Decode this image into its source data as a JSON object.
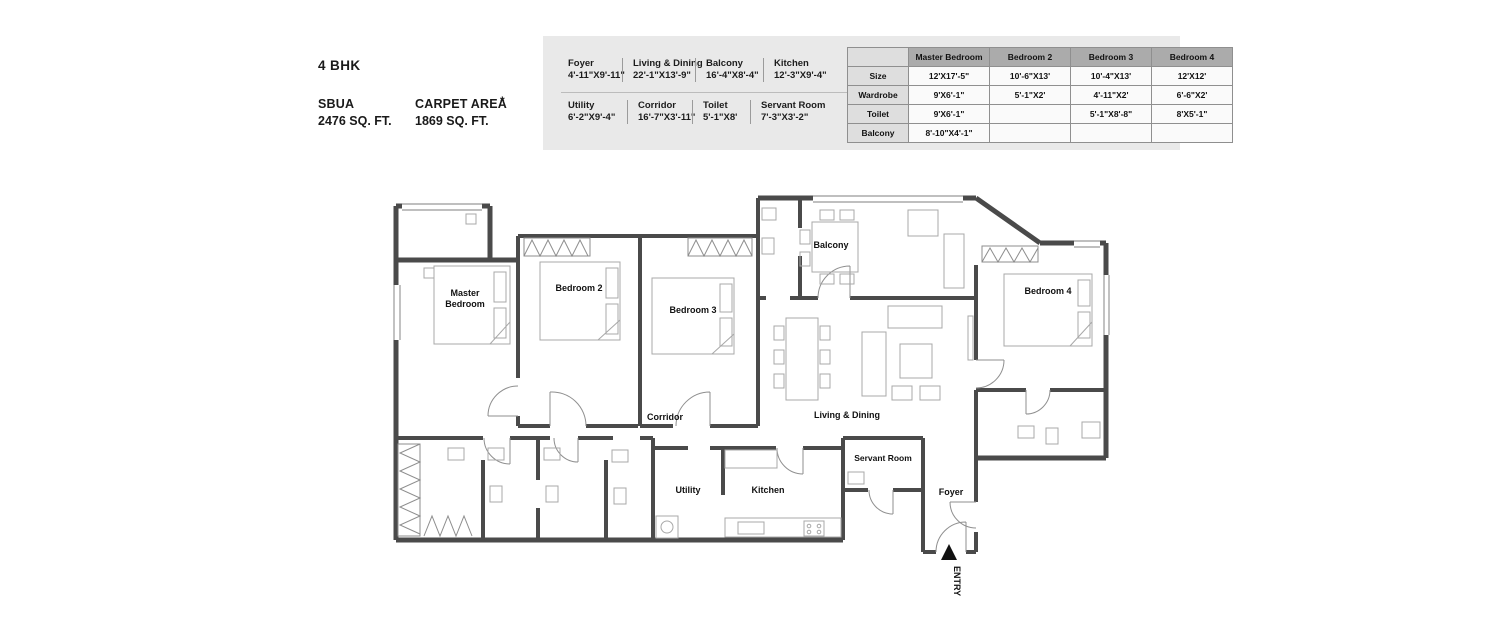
{
  "header": {
    "title": "4 BHK",
    "sbua_label": "SBUA",
    "sbua_value": "2476 SQ. FT.",
    "carpet_label": "CARPET AREA",
    "carpet_note": "*",
    "carpet_value": "1869 SQ. FT."
  },
  "dimensions_panel": {
    "row1": [
      {
        "name": "Foyer",
        "size": "4'-11\"X9'-11\""
      },
      {
        "name": "Living & Dining",
        "size": "22'-1\"X13'-9\""
      },
      {
        "name": "Balcony",
        "size": "16'-4\"X8'-4\""
      },
      {
        "name": "Kitchen",
        "size": "12'-3\"X9'-4\""
      }
    ],
    "row2": [
      {
        "name": "Utility",
        "size": "6'-2\"X9'-4\""
      },
      {
        "name": "Corridor",
        "size": "16'-7\"X3'-11\""
      },
      {
        "name": "Toilet",
        "size": "5'-1\"X8'"
      },
      {
        "name": "Servant Room",
        "size": "7'-3\"X3'-2\""
      }
    ]
  },
  "bedroom_table": {
    "columns": [
      "",
      "Master Bedroom",
      "Bedroom 2",
      "Bedroom 3",
      "Bedroom 4"
    ],
    "rows": [
      {
        "label": "Size",
        "values": [
          "12'X17'-5\"",
          "10'-6\"X13'",
          "10'-4\"X13'",
          "12'X12'"
        ]
      },
      {
        "label": "Wardrobe",
        "values": [
          "9'X6'-1\"",
          "5'-1\"X2'",
          "4'-11\"X2'",
          "6'-6\"X2'"
        ]
      },
      {
        "label": "Toilet",
        "values": [
          "9'X6'-1\"",
          "",
          "5'-1\"X8'-8\"",
          "8'X5'-1\""
        ]
      },
      {
        "label": "Balcony",
        "values": [
          "8'-10\"X4'-1\"",
          "",
          "",
          ""
        ]
      }
    ]
  },
  "floor_plan": {
    "labels": {
      "master_line1": "Master",
      "master_line2": "Bedroom",
      "bedroom2": "Bedroom 2",
      "bedroom3": "Bedroom 3",
      "bedroom4": "Bedroom 4",
      "balcony": "Balcony",
      "living_dining": "Living & Dining",
      "corridor": "Corridor",
      "utility": "Utility",
      "kitchen": "Kitchen",
      "servant_room": "Servant Room",
      "foyer": "Foyer",
      "entry": "ENTRY"
    },
    "colors": {
      "wall": "#4a4a4a",
      "furniture": "#a8a8a8",
      "panel_background": "#e9e9e9",
      "table_header": "#ababab"
    }
  }
}
